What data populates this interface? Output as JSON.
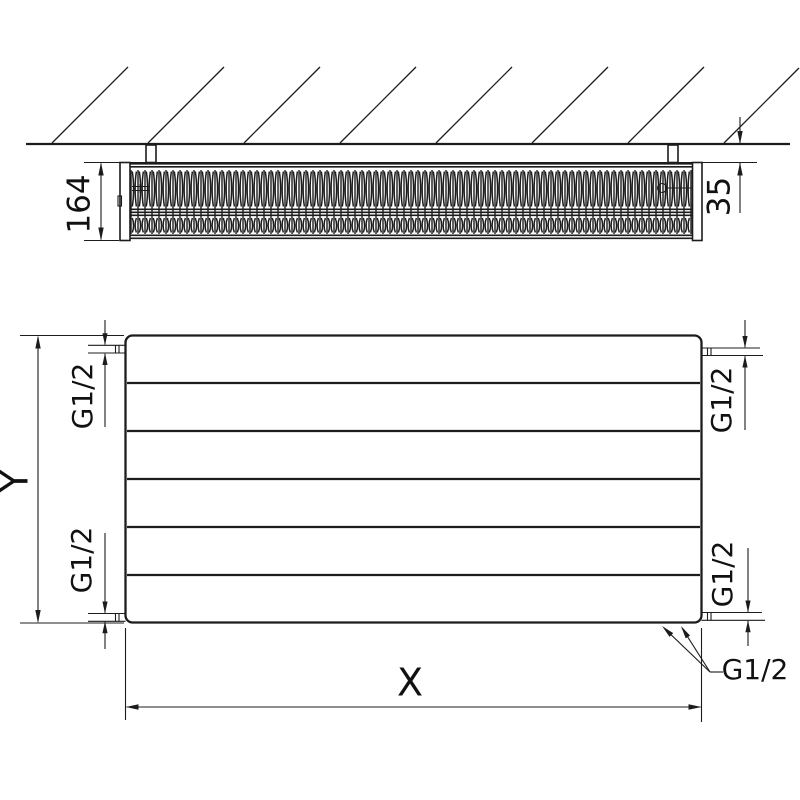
{
  "drawing_title": "radiator-installation-technical-drawing",
  "colors": {
    "line": "#1c1c1c",
    "background": "#ffffff",
    "text": "#111111"
  },
  "top_view": {
    "depth_dim": "164",
    "wall_gap_dim": "35"
  },
  "front_view": {
    "height_dim": "Y",
    "width_dim": "X",
    "conn_top_left": "G1/2",
    "conn_bottom_left": "G1/2",
    "conn_top_right": "G1/2",
    "conn_bottom_right": "G1/2",
    "conn_bottom_leader": "G1/2"
  }
}
